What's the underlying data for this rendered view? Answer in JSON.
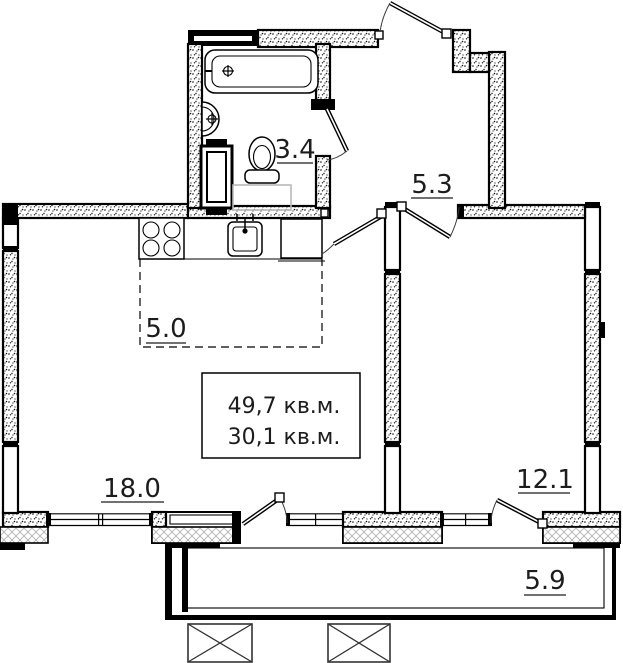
{
  "plan": {
    "rooms": {
      "bathroom": {
        "label": "3.4"
      },
      "hall": {
        "label": "5.3"
      },
      "kitchen": {
        "label": "5.0"
      },
      "living_room": {
        "label": "18.0"
      },
      "bedroom": {
        "label": "12.1"
      },
      "balcony": {
        "label": "5.9"
      }
    },
    "area_box": {
      "total_area": "49,7 кв.м.",
      "living_area": "30,1 кв.м."
    },
    "colors": {
      "wall": "#000000",
      "hatch_gray": "#b3b3b3",
      "label_text": "#1c1c1c"
    }
  }
}
